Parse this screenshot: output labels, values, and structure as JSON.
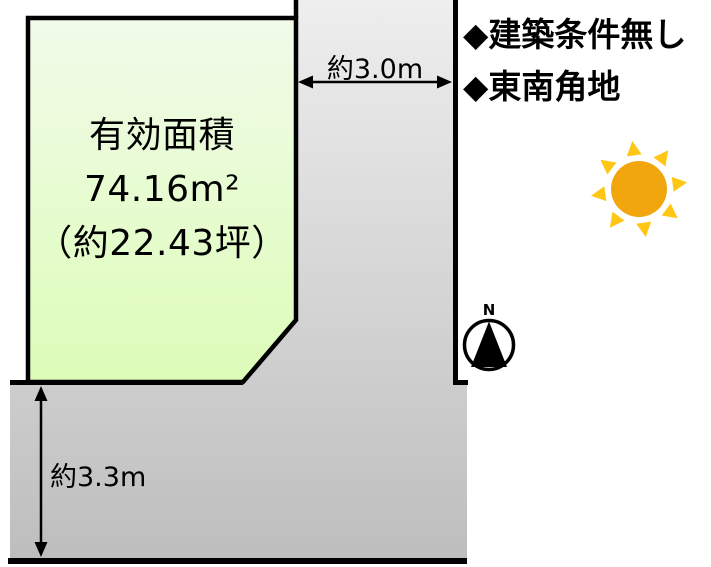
{
  "diagram": {
    "plot": {
      "area_title": "有効面積",
      "area_m2": "74.16m²",
      "area_tsubo": "（約22.43坪）"
    },
    "dimensions": {
      "east_road_width": "約3.0m",
      "south_road_width": "約3.3m"
    },
    "notes": {
      "building_conditions": "◆建築条件無し",
      "corner_lot": "◆東南角地"
    },
    "compass": {
      "north_label": "N"
    },
    "colors": {
      "plot_fill_top": "#f1fbea",
      "plot_fill_bottom": "#ddfcb8",
      "road_fill_top": "#ededed",
      "road_fill_bottom": "#bfbfbf",
      "outline": "#000000",
      "sun_disc": "#f2a60d",
      "sun_rays": "#ffc615"
    }
  }
}
